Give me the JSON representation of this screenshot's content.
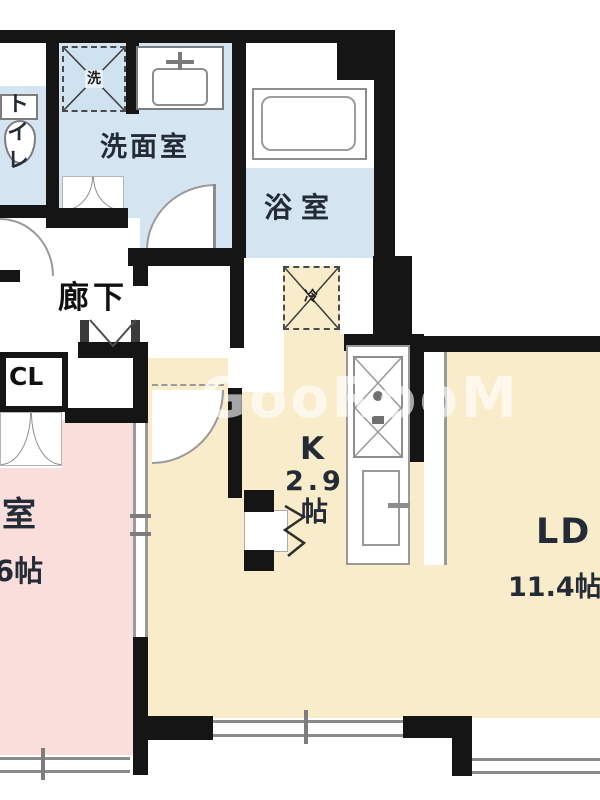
{
  "watermark": "GooRooM",
  "rooms": {
    "toilet": {
      "label": "トイレ"
    },
    "washroom": {
      "label": "洗面室"
    },
    "bathroom": {
      "label": "浴室"
    },
    "hallway": {
      "label": "廊下"
    },
    "closet": {
      "label": "CL"
    },
    "western_room": {
      "label": "洋室",
      "size": "6帖"
    },
    "kitchen": {
      "label": "K",
      "size": "2.9",
      "unit": "帖"
    },
    "living_dining": {
      "label": "LD",
      "size": "11.4帖"
    }
  },
  "fixtures": {
    "washing_machine": "洗",
    "refrigerator": "冷"
  },
  "colors": {
    "wall": "#151515",
    "wet_room": "#d5e4f1",
    "western_room": "#f9dedb",
    "kitchen_ld": "#f9ecca"
  }
}
